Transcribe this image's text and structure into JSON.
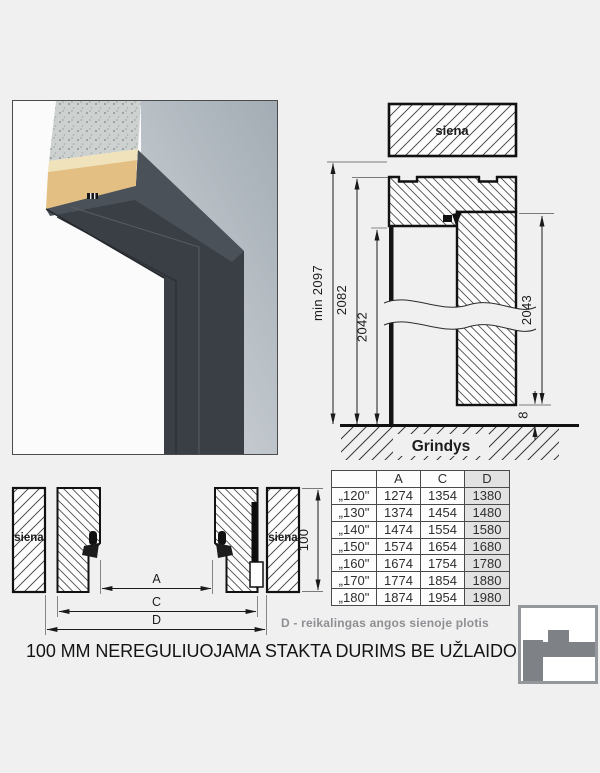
{
  "captions": {
    "legend": "D - reikalingas angos sienoje plotis",
    "title": "100 MM NEREGULIUOJAMA STAKTA DURIMS BE UŽLAIDOS"
  },
  "vertical_section": {
    "wall_label": "siena",
    "floor_label": "Grindys",
    "dim_min_height": "min 2097",
    "dim_frame_height": "2082",
    "dim_opening_height": "2042",
    "dim_leaf_height": "2043",
    "dim_floor_gap": "8"
  },
  "horizontal_section": {
    "left_wall_label": "siena",
    "right_wall_label": "siena",
    "dim_frame_depth": "100",
    "dim_a_label": "A",
    "dim_c_label": "C",
    "dim_d_label": "D"
  },
  "size_table": {
    "headers": [
      "",
      "A",
      "C",
      "D"
    ],
    "rows": [
      [
        "„120\"",
        "1274",
        "1354",
        "1380"
      ],
      [
        "„130\"",
        "1374",
        "1454",
        "1480"
      ],
      [
        "„140\"",
        "1474",
        "1554",
        "1580"
      ],
      [
        "„150\"",
        "1574",
        "1654",
        "1680"
      ],
      [
        "„160\"",
        "1674",
        "1754",
        "1780"
      ],
      [
        "„170\"",
        "1774",
        "1854",
        "1880"
      ],
      [
        "„180\"",
        "1874",
        "1954",
        "1980"
      ]
    ]
  },
  "colors": {
    "background": "#f0f0f1",
    "line": "#1c1c1c",
    "legend_gray": "#8d8f92",
    "table_highlight": "#e2e2e3",
    "frame_render": "#3b4046",
    "wall_render": "#a8b1b8"
  }
}
